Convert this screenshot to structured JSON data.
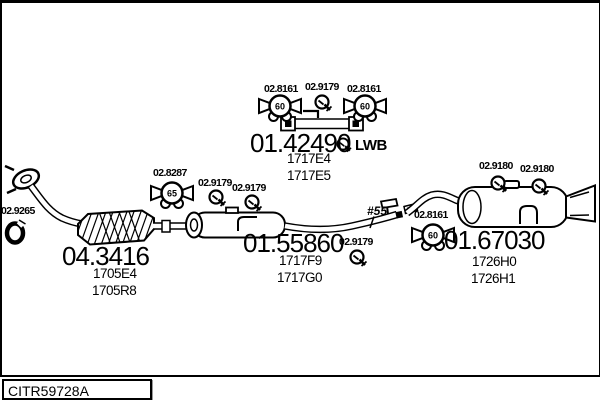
{
  "footer": {
    "code": "CITR59728A"
  },
  "icon_values": {
    "mount_60": "60",
    "mount_65": "65"
  },
  "assemblies": {
    "front_pipe": {
      "clamp_label": "02.9265",
      "part_number": "04.3416",
      "oe_refs": [
        "1705E4",
        "1705R8"
      ]
    },
    "lwb_pipe": {
      "mount_left_label": "02.8161",
      "clamp_label": "02.9179",
      "mount_right_label": "02.8161",
      "part_number": "01.42490",
      "variant": "LWB",
      "oe_refs": [
        "1717E4",
        "1717E5"
      ]
    },
    "centre_muffler": {
      "mount_label": "02.8287",
      "clamp1_label": "02.9179",
      "clamp2_label": "02.9179",
      "clamp3_label": "02.9179",
      "part_number": "01.55860",
      "oe_refs": [
        "1717F9",
        "1717G0"
      ],
      "joint_ref": "#55"
    },
    "rear_muffler": {
      "clamp1_label": "02.9180",
      "clamp2_label": "02.9180",
      "mount_label": "02.8161",
      "part_number": "01.67030",
      "oe_refs": [
        "1726H0",
        "1726H1"
      ]
    }
  }
}
